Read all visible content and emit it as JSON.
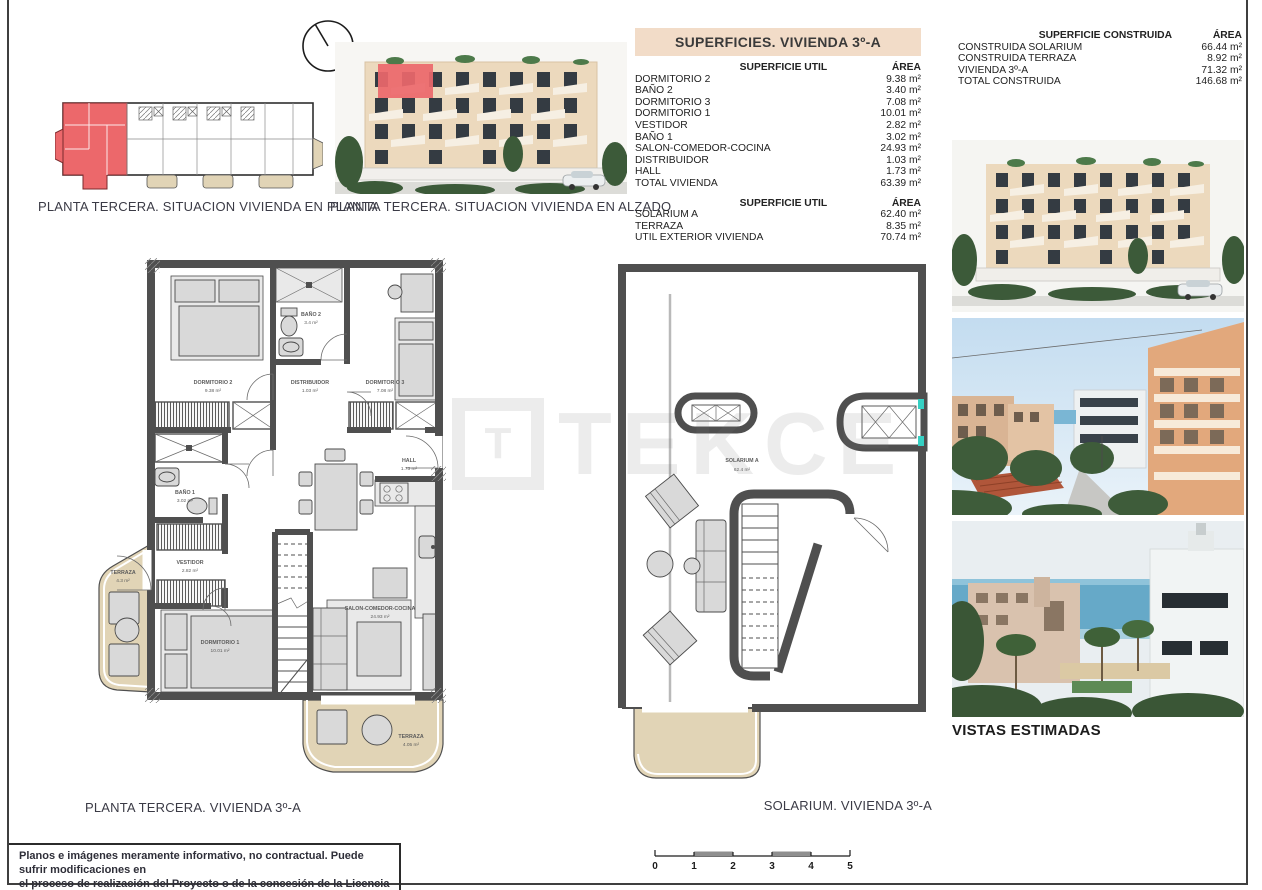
{
  "page": {
    "watermark_initial": "T",
    "watermark": "TEKCE",
    "disclaimer": {
      "line1": "Planos e imágenes meramente informativo, no contractual. Puede sufrir modificaciones en",
      "line2": "el proceso de realización del Proyecto o de la concesión de la Licencia de Construcción."
    }
  },
  "colors": {
    "highlight_red": "#ec686b",
    "terrace_beige": "#e1d4b6",
    "wall_gray": "#4f4f4f",
    "table_header_bg": "#f2dcc8"
  },
  "site_plan": {
    "caption": "PLANTA TERCERA. SITUACION VIVIENDA EN PLANTA"
  },
  "elevation": {
    "caption": "PLANTA TERCERA. SITUACION VIVIENDA EN ALZADO"
  },
  "superficies_table": {
    "title": "SUPERFICIES. VIVIENDA 3º-A",
    "sections": [
      {
        "header_label": "SUPERFICIE UTIL",
        "header_area": "ÁREA",
        "rows": [
          {
            "label": "DORMITORIO 2",
            "value": "9.38 m²"
          },
          {
            "label": "BAÑO 2",
            "value": "3.40 m²"
          },
          {
            "label": "DORMITORIO 3",
            "value": "7.08 m²"
          },
          {
            "label": "DORMITORIO 1",
            "value": "10.01 m²"
          },
          {
            "label": "VESTIDOR",
            "value": "2.82 m²"
          },
          {
            "label": "BAÑO 1",
            "value": "3.02 m²"
          },
          {
            "label": "SALON-COMEDOR-COCINA",
            "value": "24.93 m²"
          },
          {
            "label": "DISTRIBUIDOR",
            "value": "1.03 m²"
          },
          {
            "label": "HALL",
            "value": "1.73 m²"
          },
          {
            "label": "TOTAL VIVIENDA",
            "value": "63.39 m²"
          }
        ]
      },
      {
        "header_label": "SUPERFICIE UTIL",
        "header_area": "ÁREA",
        "rows": [
          {
            "label": "SOLARIUM A",
            "value": "62.40 m²"
          },
          {
            "label": "TERRAZA",
            "value": "8.35 m²"
          },
          {
            "label": "UTIL EXTERIOR VIVIENDA",
            "value": "70.74 m²"
          }
        ]
      }
    ]
  },
  "construida_table": {
    "header_label": "SUPERFICIE CONSTRUIDA",
    "header_area": "ÁREA",
    "rows": [
      {
        "label": "CONSTRUIDA SOLARIUM",
        "value": "66.44 m²"
      },
      {
        "label": "CONSTRUIDA TERRAZA",
        "value": "8.92 m²"
      },
      {
        "label": "VIVIENDA 3º-A",
        "value": "71.32 m²"
      },
      {
        "label": "TOTAL CONSTRUIDA",
        "value": "146.68 m²"
      }
    ]
  },
  "floor_plan": {
    "caption": "PLANTA  TERCERA. VIVIENDA 3º-A",
    "rooms": {
      "dormitorio2": {
        "name": "DORMITORIO 2",
        "area": "9.38 m²"
      },
      "bano2": {
        "name": "BAÑO 2",
        "area": "3.4 m²"
      },
      "distribuidor": {
        "name": "DISTRIBUIDOR",
        "area": "1.03 m²"
      },
      "dormitorio3": {
        "name": "DORMITORIO 3",
        "area": "7.08 m²"
      },
      "hall": {
        "name": "HALL",
        "area": "1.73 m²"
      },
      "bano1": {
        "name": "BAÑO 1",
        "area": "3.02 m²"
      },
      "vestidor": {
        "name": "VESTIDOR",
        "area": "2.82 m²"
      },
      "dormitorio1": {
        "name": "DORMITORIO 1",
        "area": "10.01 m²"
      },
      "salon": {
        "name": "SALON-COMEDOR-COCINA",
        "area": "24.93 m²"
      },
      "terraza_izq": {
        "name": "TERRAZA",
        "area": "4.3 m²"
      },
      "terraza_inf": {
        "name": "TERRAZA",
        "area": "4.05 m²"
      }
    }
  },
  "solarium_plan": {
    "caption": "SOLARIUM. VIVIENDA 3º-A",
    "room_name": "SOLARIUM A",
    "room_area": "62.4 m²"
  },
  "scale_bar": {
    "labels": [
      "0",
      "1",
      "2",
      "3",
      "4",
      "5"
    ]
  },
  "photos": {
    "vistas_label": "VISTAS ESTIMADAS"
  }
}
